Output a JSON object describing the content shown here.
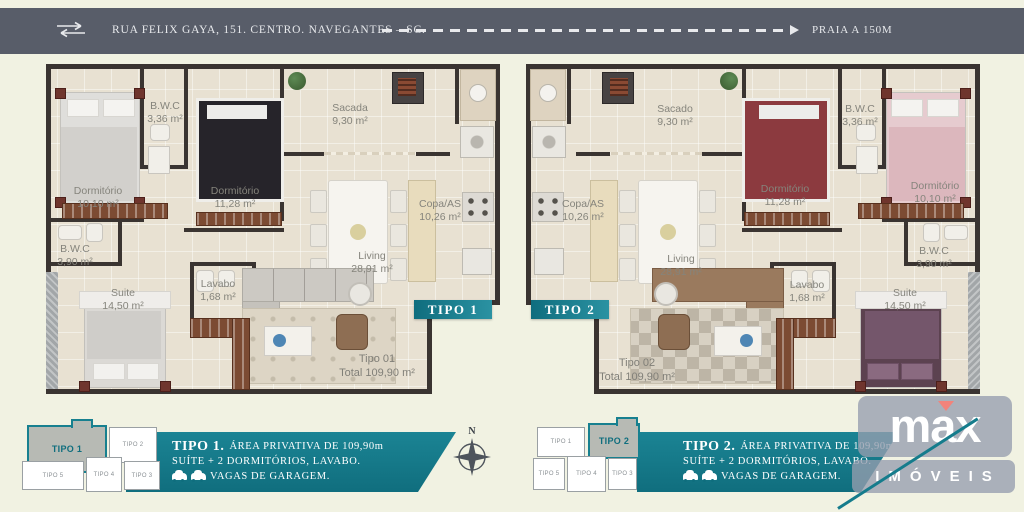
{
  "header": {
    "address": "RUA FELIX GAYA, 151. CENTRO. NAVEGANTES – SC.",
    "distance_label": "PRAIA A 150M",
    "bar_color": "#585d69"
  },
  "plans": [
    {
      "tag": "TIPO 1",
      "total_line1": "Tipo 01",
      "total_line2": "Total 109,90 m²",
      "rooms": [
        {
          "name": "Dormitório",
          "area": "10,10 m²"
        },
        {
          "name": "B.W.C",
          "area": "3,36 m²"
        },
        {
          "name": "Dormitório",
          "area": "11,28 m²"
        },
        {
          "name": "Sacada",
          "area": "9,30 m²"
        },
        {
          "name": "Copa/AS",
          "area": "10,26 m²"
        },
        {
          "name": "Living",
          "area": "28,91 m²"
        },
        {
          "name": "B.W.C",
          "area": "3,90 m²"
        },
        {
          "name": "Suite",
          "area": "14,50 m²"
        },
        {
          "name": "Lavabo",
          "area": "1,68 m²"
        }
      ]
    },
    {
      "tag": "TIPO 2",
      "total_line1": "Tipo 02",
      "total_line2": "Total 109,90 m²",
      "rooms": [
        {
          "name": "Dormitório",
          "area": "10,10 m²"
        },
        {
          "name": "B.W.C",
          "area": "3,36 m²"
        },
        {
          "name": "Dormitório",
          "area": "11,28 m²"
        },
        {
          "name": "Sacado",
          "area": "9,30 m²"
        },
        {
          "name": "Copa/AS",
          "area": "10,26 m²"
        },
        {
          "name": "Living",
          "area": "28,91 m²"
        },
        {
          "name": "B.W.C",
          "area": "3,90 m²"
        },
        {
          "name": "Suite",
          "area": "14,50 m²"
        },
        {
          "name": "Lavabo",
          "area": "1,68 m²"
        }
      ]
    }
  ],
  "footer": {
    "key_items": [
      "TIPO 1",
      "TIPO 2",
      "TIPO 5",
      "TIPO 4",
      "TIPO 3"
    ],
    "left_info": {
      "title": "TIPO 1.",
      "area_line": "ÁREA PRIVATIVA DE 109,90m",
      "rooms_line": "SUÍTE + 2 DORMITÓRIOS, LAVABO.",
      "garage_line": "VAGAS DE GARAGEM."
    },
    "right_info": {
      "title": "TIPO 2.",
      "area_line": "ÁREA PRIVATIVA DE 109,90m",
      "rooms_line": "SUÍTE + 2 DORMITÓRIOS, LAVABO.",
      "garage_line": "VAGAS DE GARAGEM."
    },
    "compass_label": "N",
    "logo": {
      "brand": "max",
      "sub": "IMÓVEIS"
    }
  },
  "colors": {
    "teal": "#157c8c",
    "cream": "#f1f2e2",
    "wall": "#3a3431",
    "header_bar": "#585d69",
    "accent_red": "#f2837b"
  }
}
